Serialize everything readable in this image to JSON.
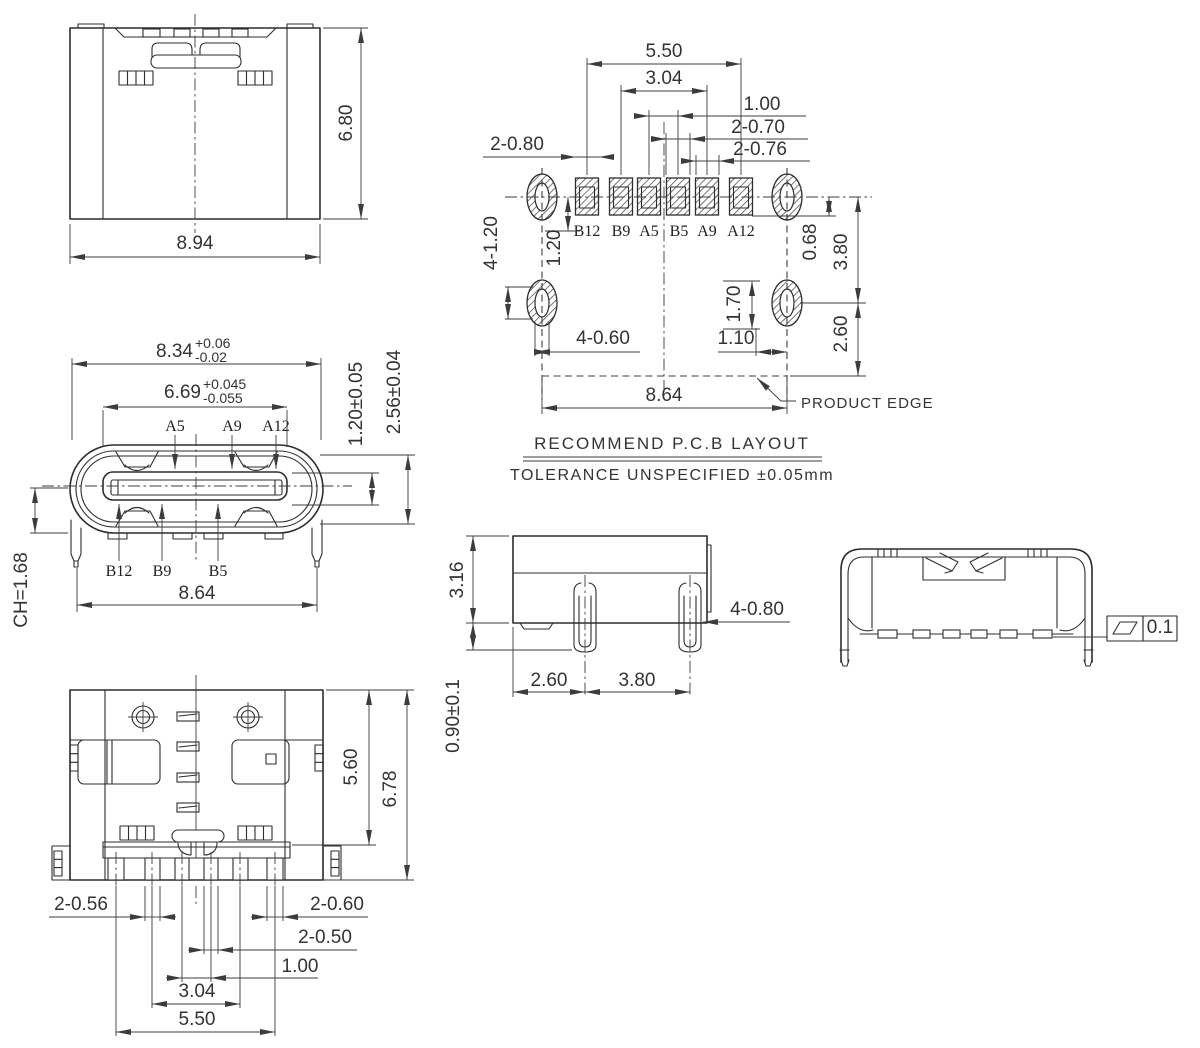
{
  "rear_view": {
    "dim_width": "8.94",
    "dim_height": "6.80"
  },
  "pcb_layout": {
    "pad_labels": [
      "B12",
      "B9",
      "A5",
      "B5",
      "A9",
      "A12"
    ],
    "dim_pitch_outer": "5.50",
    "dim_pitch_mid": "3.04",
    "dim_pitch_inner": "1.00",
    "dim_pad_width_inner": "2-0.70",
    "dim_pad_width_mid": "2-0.76",
    "dim_pad_width_outer": "2-0.80",
    "dim_hole_width": "4-1.20",
    "dim_pad_offset": "1.20",
    "dim_edge_offset": "0.68",
    "dim_hole_span": "3.80",
    "dim_hole_height": "1.70",
    "dim_hole_inset": "1.10",
    "dim_hole_dia": "4-0.60",
    "dim_edge_bottom": "2.60",
    "dim_width": "8.64",
    "product_edge_label": "PRODUCT EDGE",
    "title": "RECOMMEND P.C.B LAYOUT",
    "tolerance_note": "TOLERANCE UNSPECIFIED ±0.05mm"
  },
  "front_view": {
    "top_pin_labels": [
      "A5",
      "A9",
      "A12"
    ],
    "bottom_pin_labels": [
      "B12",
      "B9",
      "B5"
    ],
    "dim_shell_width_nominal": "8.34",
    "dim_shell_width_tol_upper": "+0.06",
    "dim_shell_width_tol_lower": "-0.02",
    "dim_tongue_width_nominal": "6.69",
    "dim_tongue_width_tol_upper": "+0.045",
    "dim_tongue_width_tol_lower": "-0.055",
    "dim_tongue_thickness": "1.20±0.05",
    "dim_cavity_height": "2.56±0.04",
    "dim_chamfer": "CH=1.68",
    "dim_leg_span": "8.64"
  },
  "bottom_view": {
    "dim_body_depth": "5.60",
    "dim_overall_depth": "6.78",
    "dim_pin_width_a": "2-0.56",
    "dim_pin_width_b": "2-0.60",
    "dim_pin_width_c": "2-0.50",
    "dim_pitch_inner": "1.00",
    "dim_pitch_mid": "3.04",
    "dim_pitch_outer": "5.50"
  },
  "side_view": {
    "dim_height": "3.16",
    "dim_standoff": "0.90±0.1",
    "dim_leg_a": "2.60",
    "dim_leg_b": "3.80",
    "dim_leg_width": "4-0.80"
  },
  "top_view": {
    "flatness_value": "0.1"
  }
}
